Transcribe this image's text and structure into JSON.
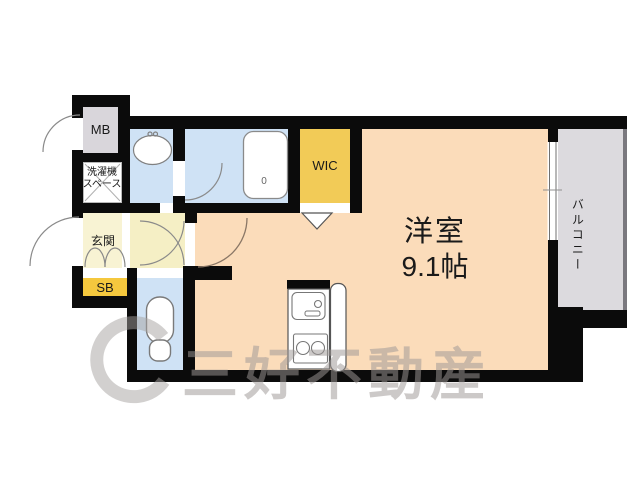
{
  "floorplan": {
    "rooms": {
      "mb": "MB",
      "laundry_line1": "洗濯機",
      "laundry_line2": "スペース",
      "genkan": "玄関",
      "sb": "SB",
      "wic": "WIC",
      "main_name": "洋室",
      "main_size": "9.1帖",
      "balcony": "バルコニー",
      "tub_mark": "0"
    },
    "watermark_text": "三好不動産",
    "colors": {
      "wall": "#0b0b0b",
      "main_room": "#fbdcba",
      "wet_area": "#cfe2f5",
      "wic": "#f2cb57",
      "sb": "#f5c83e",
      "genkan": "#f8f3d3",
      "hall": "#f5efc5",
      "mb": "#d9d6db",
      "balcony": "#dcdade"
    }
  }
}
